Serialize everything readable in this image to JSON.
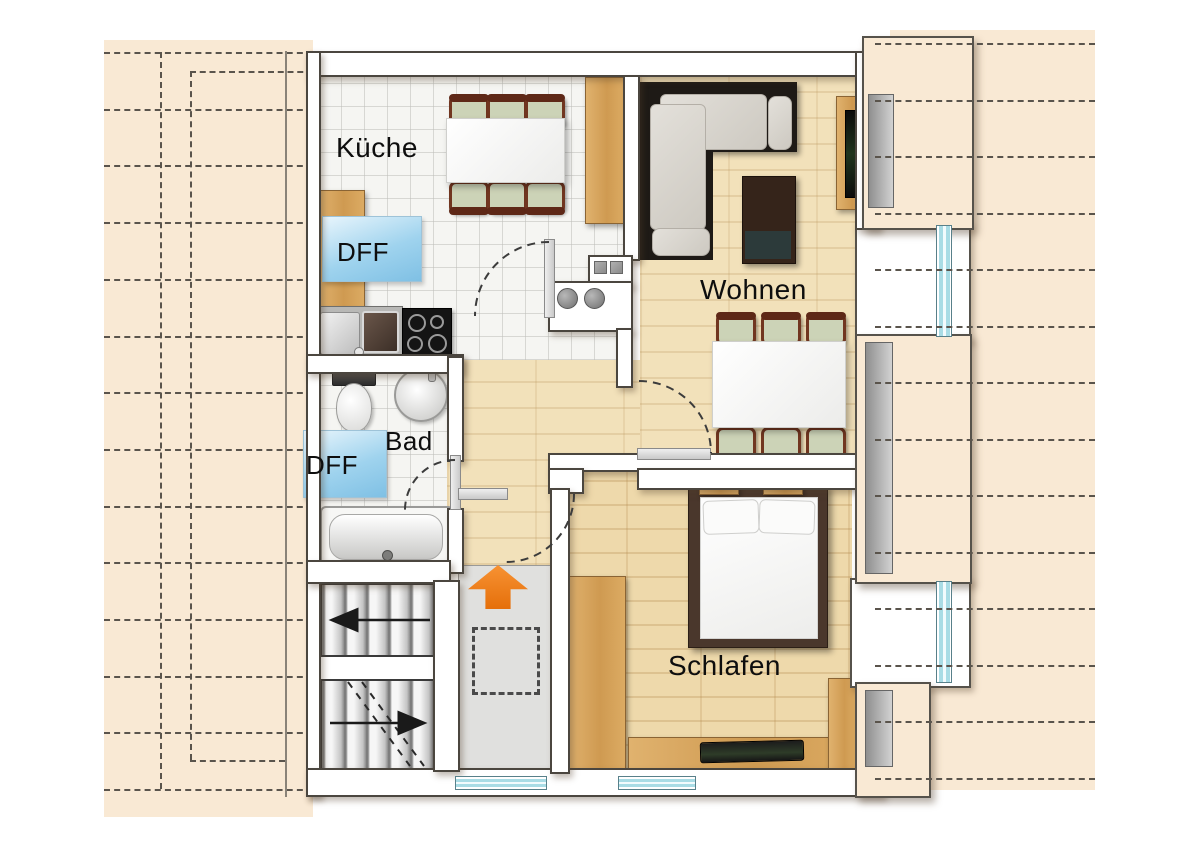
{
  "title": "Dachgeschoss Wohnung Grundriss",
  "labels": {
    "kitchen": "Küche",
    "skylight_kitchen": "DFF",
    "bath": "Bad",
    "skylight_bath": "DFF",
    "living": "Wohnen",
    "bedroom": "Schlafen"
  },
  "rooms": [
    {
      "name": "kitchen",
      "label": "Küche",
      "floor": "tile"
    },
    {
      "name": "bath",
      "label": "Bad",
      "floor": "tile"
    },
    {
      "name": "living-room",
      "label": "Wohnen",
      "floor": "wood"
    },
    {
      "name": "bedroom",
      "label": "Schlafen",
      "floor": "wood"
    },
    {
      "name": "hallway",
      "label": "",
      "floor": "wood"
    },
    {
      "name": "stairwell",
      "label": "",
      "floor": "gray"
    }
  ],
  "symbols": {
    "entrance_arrow": "orange up-arrow at apartment entrance",
    "skylights": 2,
    "door_arcs": 4,
    "stair_flights": 2
  },
  "colors": {
    "roof": "#f9e9d4",
    "dash": "#5a544c",
    "wall_outline": "#4b463f",
    "window_glass": "#a9dce5",
    "skylight_blue": "#9fd3ee",
    "wood_floor": "#f2e1ba",
    "furniture_wood": "#d7a35e",
    "sofa_frame": "#1e1a16",
    "bed_frame": "#4a372c",
    "arrow_orange": "#ef7c15",
    "landing_gray": "#e0e0de"
  }
}
